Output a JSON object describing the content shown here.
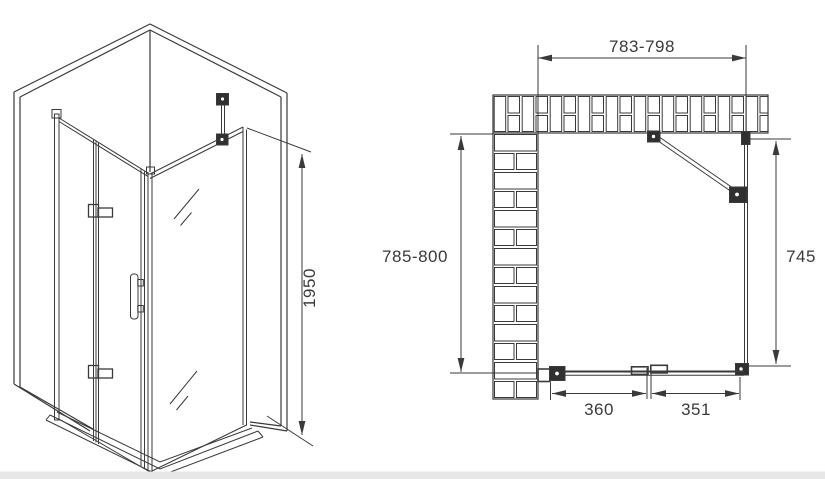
{
  "drawing": {
    "background_color": "#ffffff",
    "line_color": "#3a3a3a",
    "iso_view": {
      "height_label": "1950"
    },
    "plan_view": {
      "overall_width_label": "783-798",
      "overall_depth_label": "785-800",
      "side_panel_label": "745",
      "door_segment_left_label": "360",
      "door_segment_right_label": "351"
    }
  }
}
